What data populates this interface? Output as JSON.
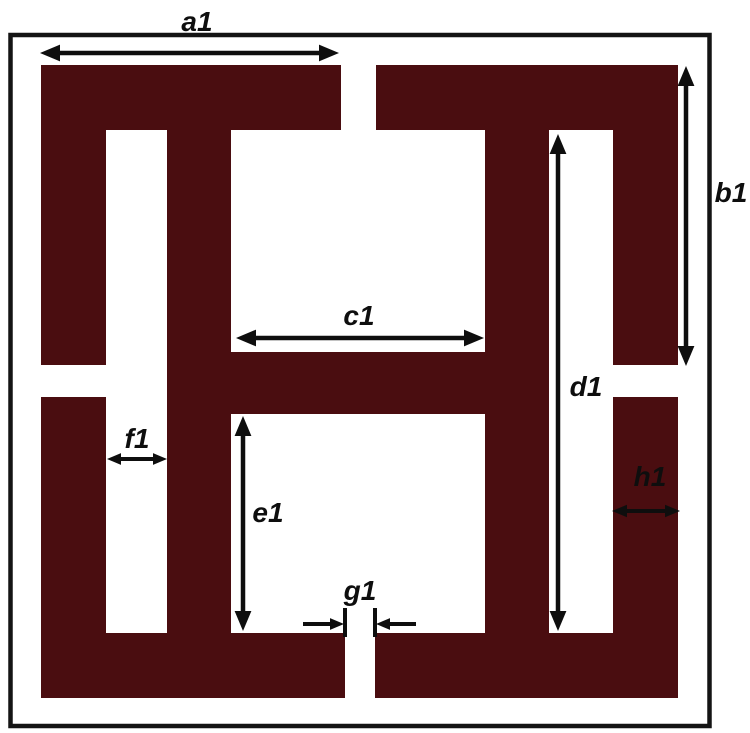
{
  "canvas": {
    "width": 750,
    "height": 733,
    "background": "#ffffff"
  },
  "colors": {
    "structure": "#4a0d10",
    "frame": "#141414",
    "annotation": "#0e0e0e",
    "background": "#ffffff"
  },
  "frame": {
    "x": 10.5,
    "y": 35,
    "width": 699,
    "height": 691,
    "stroke_width": 4.5
  },
  "structure": {
    "rects": [
      {
        "name": "top-left-bar",
        "x": 41,
        "y": 65,
        "w": 300,
        "h": 65
      },
      {
        "name": "top-right-bar",
        "x": 376,
        "y": 65,
        "w": 302,
        "h": 65
      },
      {
        "name": "left-bar-upper",
        "x": 41,
        "y": 65,
        "w": 65,
        "h": 300
      },
      {
        "name": "left-bar-lower",
        "x": 41,
        "y": 397,
        "w": 65,
        "h": 301
      },
      {
        "name": "right-bar-upper",
        "x": 613,
        "y": 65,
        "w": 65,
        "h": 300
      },
      {
        "name": "right-bar-lower",
        "x": 613,
        "y": 397,
        "w": 65,
        "h": 301
      },
      {
        "name": "bottom-left-bar",
        "x": 41,
        "y": 633,
        "w": 304,
        "h": 65
      },
      {
        "name": "bottom-right-bar",
        "x": 375,
        "y": 633,
        "w": 303,
        "h": 65
      },
      {
        "name": "middle-left-bar",
        "x": 167,
        "y": 65,
        "w": 64,
        "h": 633
      },
      {
        "name": "middle-right-bar",
        "x": 485,
        "y": 65,
        "w": 64,
        "h": 633
      },
      {
        "name": "center-crossbar",
        "x": 167,
        "y": 352,
        "w": 382,
        "h": 62
      }
    ]
  },
  "dimension_labels": [
    {
      "id": "a1",
      "text": "a1",
      "label": {
        "x": 197,
        "y": 31
      },
      "arrow": {
        "kind": "double",
        "orient": "h",
        "at": 53,
        "from": 40,
        "to": 339,
        "head": 20,
        "width": 4.5
      }
    },
    {
      "id": "b1",
      "text": "b1",
      "label": {
        "x": 731,
        "y": 202
      },
      "arrow": {
        "kind": "double",
        "orient": "v",
        "at": 686,
        "from": 66,
        "to": 366,
        "head": 20,
        "width": 4.5
      }
    },
    {
      "id": "c1",
      "text": "c1",
      "label": {
        "x": 359,
        "y": 325
      },
      "arrow": {
        "kind": "double",
        "orient": "h",
        "at": 338,
        "from": 236,
        "to": 484,
        "head": 20,
        "width": 4.5
      }
    },
    {
      "id": "d1",
      "text": "d1",
      "label": {
        "x": 586,
        "y": 396
      },
      "arrow": {
        "kind": "double",
        "orient": "v",
        "at": 558,
        "from": 134,
        "to": 631,
        "head": 20,
        "width": 4.5
      }
    },
    {
      "id": "e1",
      "text": "e1",
      "label": {
        "x": 268,
        "y": 522
      },
      "arrow": {
        "kind": "double",
        "orient": "v",
        "at": 243,
        "from": 416,
        "to": 631,
        "head": 20,
        "width": 4.5
      }
    },
    {
      "id": "f1",
      "text": "f1",
      "label": {
        "x": 137,
        "y": 448
      },
      "arrow": {
        "kind": "double",
        "orient": "h",
        "at": 459,
        "from": 107,
        "to": 167,
        "head": 14,
        "width": 4
      }
    },
    {
      "id": "g1",
      "text": "g1",
      "label": {
        "x": 360,
        "y": 600
      },
      "arrow": {
        "kind": "inward",
        "orient": "h",
        "at": 624,
        "head": 14,
        "width": 4,
        "left": {
          "from": 303,
          "to": 344
        },
        "right": {
          "from": 416,
          "to": 376
        },
        "ticks": [
          {
            "x": 345,
            "y1": 608,
            "y2": 637
          },
          {
            "x": 375,
            "y1": 608,
            "y2": 637
          }
        ]
      }
    },
    {
      "id": "h1",
      "text": "h1",
      "label": {
        "x": 650,
        "y": 486
      },
      "arrow": {
        "kind": "double",
        "orient": "h",
        "at": 511,
        "from": 612,
        "to": 680,
        "head": 15,
        "width": 4
      }
    }
  ]
}
